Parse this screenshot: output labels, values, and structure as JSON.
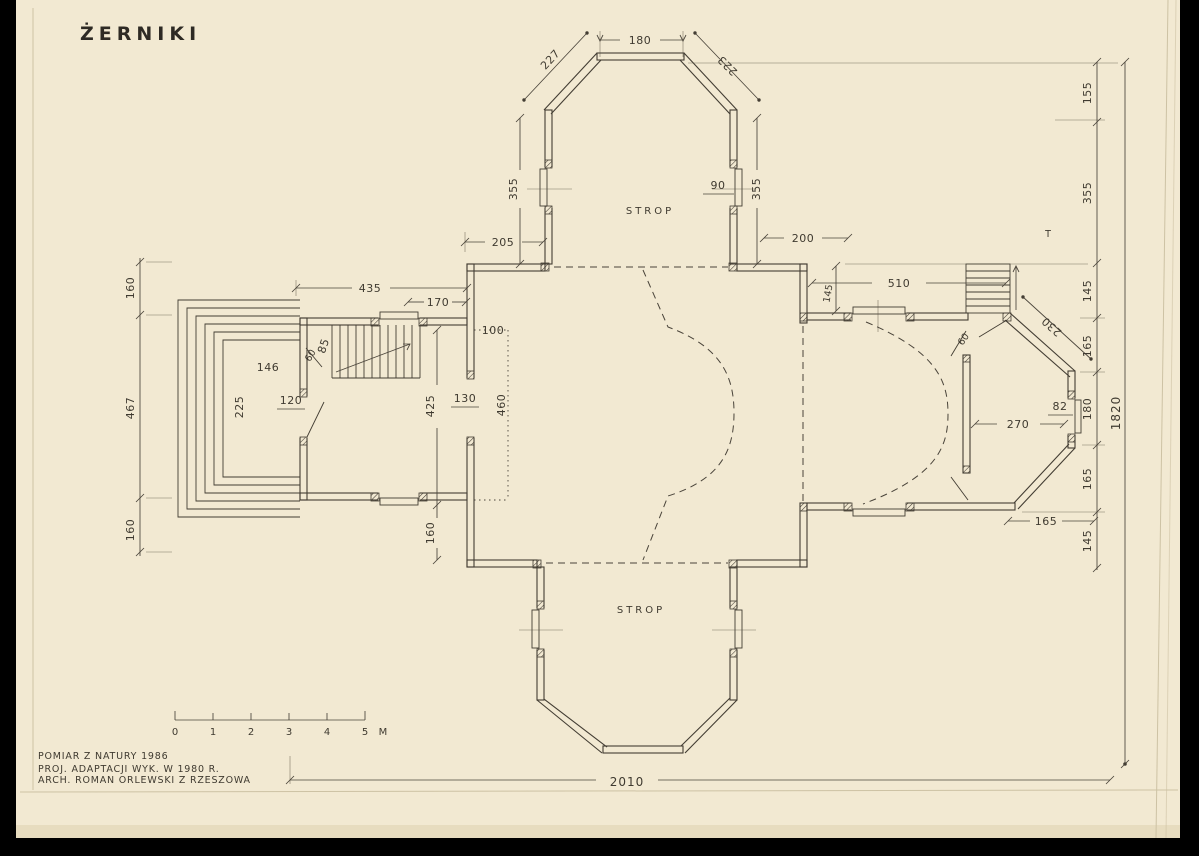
{
  "colors": {
    "paper": "#f2e9d2",
    "ink": "#433d33",
    "background": "#000000"
  },
  "title": "ŻERNIKI",
  "notes": {
    "line1": "POMIAR Z NATURY 1986",
    "line2": "PROJ. ADAPTACJI WYK. W 1980 R.",
    "line3": "ARCH. ROMAN ORLEWSKI Z RZESZOWA"
  },
  "scalebar": {
    "marks": [
      "0",
      "1",
      "2",
      "3",
      "4",
      "5"
    ],
    "unit": "M"
  },
  "plan": {
    "rooms": {
      "strop_north": "STROP",
      "strop_south": "STROP"
    },
    "marks": {
      "t_mark": "T"
    },
    "dims": {
      "north_width": "180",
      "north_diag_left": "227",
      "north_diag_right": "223",
      "north_wall_left": "355",
      "north_window_right": "90",
      "north_wall_right": "355",
      "north_off_left": "205",
      "north_off_right": "200",
      "west_top_total": "435",
      "west_top_inner": "170",
      "west_left_top": "160",
      "west_left_mid": "467",
      "west_left_bottom": "160",
      "west_room_width": "146",
      "west_room_height": "225",
      "west_door": "120",
      "west_stair_width": "85",
      "west_stair_door": "60",
      "nave_gallery_width": "100",
      "nave_opening": "130",
      "nave_wall_upper": "425",
      "nave_gallery_depth": "460",
      "nave_wall_lower": "160",
      "chancel_top": "510",
      "chancel_offset": "145",
      "chancel_diag": "230",
      "chancel_door": "60",
      "chancel_width": "270",
      "chancel_window": "82",
      "chancel_bottom_offset": "165",
      "right_chain": [
        "155",
        "355",
        "145",
        "165",
        "180",
        "165",
        "145"
      ],
      "total_height": "1820",
      "total_width": "2010"
    }
  }
}
